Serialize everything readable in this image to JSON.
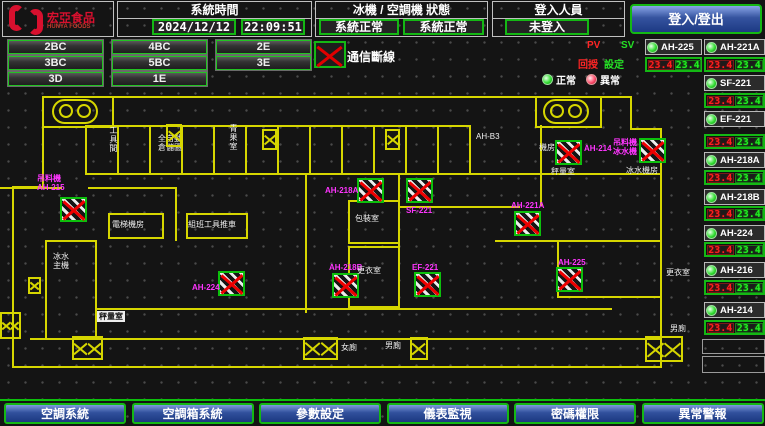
{
  "header": {
    "brand": "宏亞食品",
    "brand_en": "HUNYA FOODS",
    "system_time": {
      "label": "系統時間",
      "date": "2024/12/12",
      "time": "22:09:51"
    },
    "machine_status": {
      "label": "冰機 / 空調機 狀態",
      "chiller": "系統正常",
      "ahu": "系統正常"
    },
    "login": {
      "label": "登入人員",
      "value": "未登入",
      "button": "登入/登出"
    }
  },
  "floors": {
    "rows": [
      [
        "2BC",
        "4BC",
        "2E"
      ],
      [
        "3BC",
        "5BC",
        "3E"
      ],
      [
        "3D",
        "1E"
      ]
    ]
  },
  "comm": {
    "label": "通信斷線"
  },
  "pvsv": {
    "pv": "PV",
    "sv": "SV",
    "feedback": "回授",
    "setting": "設定"
  },
  "legend": {
    "normal": "正常",
    "abnormal": "異常"
  },
  "equipment": {
    "units": [
      {
        "name": "AH-225",
        "pv": "23.4",
        "sv": "23.4",
        "x": 645,
        "w": 57,
        "label_y": 39,
        "value_y": 57
      },
      {
        "name": "AH-221A",
        "pv": "23.4",
        "sv": "23.4",
        "x": 704,
        "w": 61,
        "label_y": 39,
        "value_y": 57
      },
      {
        "name": "SF-221",
        "pv": "23.4",
        "sv": "23.4",
        "x": 704,
        "w": 61,
        "label_y": 75,
        "value_y": 93
      },
      {
        "name": "EF-221",
        "pv": "23.4",
        "sv": "23.4",
        "x": 704,
        "w": 61,
        "label_y": 111,
        "value_y": 134
      },
      {
        "name": "AH-218A",
        "pv": "23.4",
        "sv": "23.4",
        "x": 704,
        "w": 61,
        "label_y": 152,
        "value_y": 170
      },
      {
        "name": "AH-218B",
        "pv": "23.4",
        "sv": "23.4",
        "x": 704,
        "w": 61,
        "label_y": 189,
        "value_y": 206
      },
      {
        "name": "AH-224",
        "pv": "23.4",
        "sv": "23.4",
        "x": 704,
        "w": 61,
        "label_y": 225,
        "value_y": 242
      },
      {
        "name": "AH-216",
        "pv": "23.4",
        "sv": "23.4",
        "x": 704,
        "w": 61,
        "label_y": 262,
        "value_y": 280
      },
      {
        "name": "AH-214",
        "pv": "23.4",
        "sv": "23.4",
        "x": 704,
        "w": 61,
        "label_y": 302,
        "value_y": 320
      }
    ]
  },
  "map": {
    "devices": [
      {
        "label": "吊料機\nAH-215",
        "ix": 60,
        "iy": 197,
        "lx": 37,
        "ly": 174
      },
      {
        "label": "AH-224",
        "ix": 218,
        "iy": 271,
        "lx": 192,
        "ly": 283
      },
      {
        "label": "AH-218B",
        "ix": 332,
        "iy": 273,
        "lx": 329,
        "ly": 263
      },
      {
        "label": "AH-218A",
        "ix": 357,
        "iy": 178,
        "lx": 325,
        "ly": 186
      },
      {
        "label": "SF-221",
        "ix": 406,
        "iy": 178,
        "lx": 406,
        "ly": 206
      },
      {
        "label": "AH-221A",
        "ix": 514,
        "iy": 211,
        "lx": 511,
        "ly": 201
      },
      {
        "label": "AH-225",
        "ix": 556,
        "iy": 267,
        "lx": 558,
        "ly": 258
      },
      {
        "label": "EF-221",
        "ix": 414,
        "iy": 272,
        "lx": 412,
        "ly": 263
      },
      {
        "label": "AH-214",
        "ix": 555,
        "iy": 140,
        "lx": 584,
        "ly": 144
      },
      {
        "label": "吊料機\n冰水機",
        "ix": 639,
        "iy": 138,
        "lx": 613,
        "ly": 138
      }
    ],
    "rooms": [
      {
        "text": "工具間",
        "x": 109,
        "y": 126,
        "vert": true
      },
      {
        "text": "全自動\n倉儲區",
        "x": 158,
        "y": 134
      },
      {
        "text": "青果室",
        "x": 229,
        "y": 124,
        "vert": true
      },
      {
        "text": "AH-B3",
        "x": 476,
        "y": 132
      },
      {
        "text": "電梯機房",
        "x": 112,
        "y": 220
      },
      {
        "text": "組班工具推車",
        "x": 188,
        "y": 220
      },
      {
        "text": "包裝室",
        "x": 355,
        "y": 214
      },
      {
        "text": "更衣室",
        "x": 357,
        "y": 266
      },
      {
        "text": "秤量室",
        "x": 97,
        "y": 311,
        "boxed": true
      },
      {
        "text": "女廁",
        "x": 341,
        "y": 343
      },
      {
        "text": "男廁",
        "x": 385,
        "y": 341
      },
      {
        "text": "冰水\n主機",
        "x": 53,
        "y": 252
      },
      {
        "text": "機房",
        "x": 539,
        "y": 143
      },
      {
        "text": "秤量室",
        "x": 551,
        "y": 167
      },
      {
        "text": "冰水機房",
        "x": 626,
        "y": 166
      },
      {
        "text": "更衣室",
        "x": 666,
        "y": 268
      },
      {
        "text": "男廁",
        "x": 670,
        "y": 324
      }
    ],
    "dampers": [
      {
        "x": 262,
        "y": 129,
        "w": 15,
        "h": 21,
        "cells": 1
      },
      {
        "x": 385,
        "y": 129,
        "w": 15,
        "h": 21,
        "cells": 1
      },
      {
        "x": 166,
        "y": 124,
        "w": 16,
        "h": 23,
        "cells": 1
      },
      {
        "x": 28,
        "y": 277,
        "w": 13,
        "h": 17,
        "cells": 1
      },
      {
        "x": 72,
        "y": 336,
        "w": 31,
        "h": 24,
        "cells": 2
      },
      {
        "x": 303,
        "y": 337,
        "w": 35,
        "h": 23,
        "cells": 2
      },
      {
        "x": 410,
        "y": 337,
        "w": 18,
        "h": 23,
        "cells": 1
      },
      {
        "x": 645,
        "y": 336,
        "w": 38,
        "h": 26,
        "cells": 2
      },
      {
        "x": 0,
        "y": 312,
        "w": 21,
        "h": 27,
        "cells": 2
      }
    ]
  },
  "nav": {
    "items": [
      "空調系統",
      "空調箱系統",
      "參數設定",
      "儀表監視",
      "密碼權限",
      "異常警報"
    ]
  }
}
